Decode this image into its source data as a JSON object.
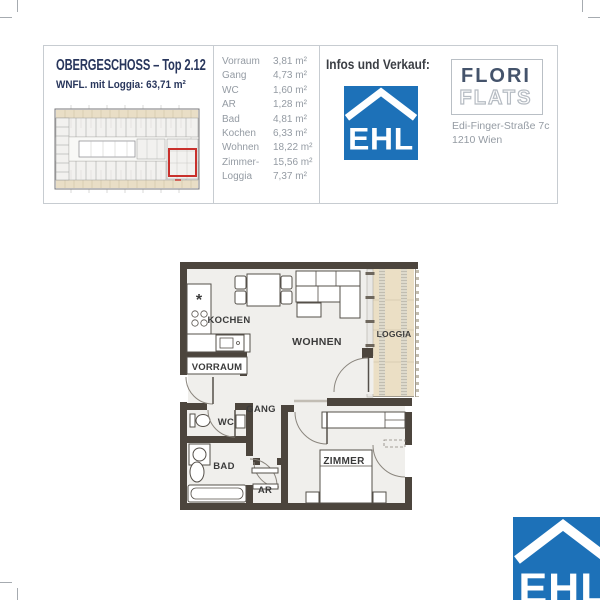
{
  "page": {
    "title": "OBERGESCHOSS – Top 2.12",
    "subtitle": "WNFL. mit Loggia: 63,71 m²"
  },
  "area_table": {
    "rows": [
      {
        "label": "Vorraum",
        "value": "3,81 m²"
      },
      {
        "label": "Gang",
        "value": "4,73 m²"
      },
      {
        "label": "WC",
        "value": "1,60 m²"
      },
      {
        "label": "AR",
        "value": "1,28 m²"
      },
      {
        "label": "Bad",
        "value": "4,81 m²"
      },
      {
        "label": "Kochen",
        "value": "6,33 m²"
      },
      {
        "label": "Wohnen",
        "value": "18,22 m²"
      },
      {
        "label": "Zimmer-",
        "value": "15,56 m²"
      },
      {
        "label": "Loggia",
        "value": "7,37 m²"
      }
    ]
  },
  "contact": {
    "heading": "Infos und Verkauf:",
    "address_line1": "Edi-Finger-Straße 7c",
    "address_line2": "1210 Wien"
  },
  "brand": {
    "ehl": "EHL",
    "flori": "FLORI",
    "flats": "FLATS"
  },
  "floorplan": {
    "labels": {
      "kochen": "KOCHEN",
      "wohnen": "WOHNEN",
      "loggia": "LOGGIA",
      "vorraum": "VORRAUM",
      "gang": "GANG",
      "wc": "WC",
      "bad": "BAD",
      "ar": "AR",
      "zimmer": "ZIMMER"
    },
    "symbols": {
      "sink": "*"
    }
  },
  "colors": {
    "ehl_blue": "#1d71b8",
    "title_navy": "#28365c",
    "text_gray": "#949ba3",
    "wall_dark": "#4c453d",
    "loggia_beige": "#ebdfc5",
    "highlight_red": "#c9302c"
  }
}
